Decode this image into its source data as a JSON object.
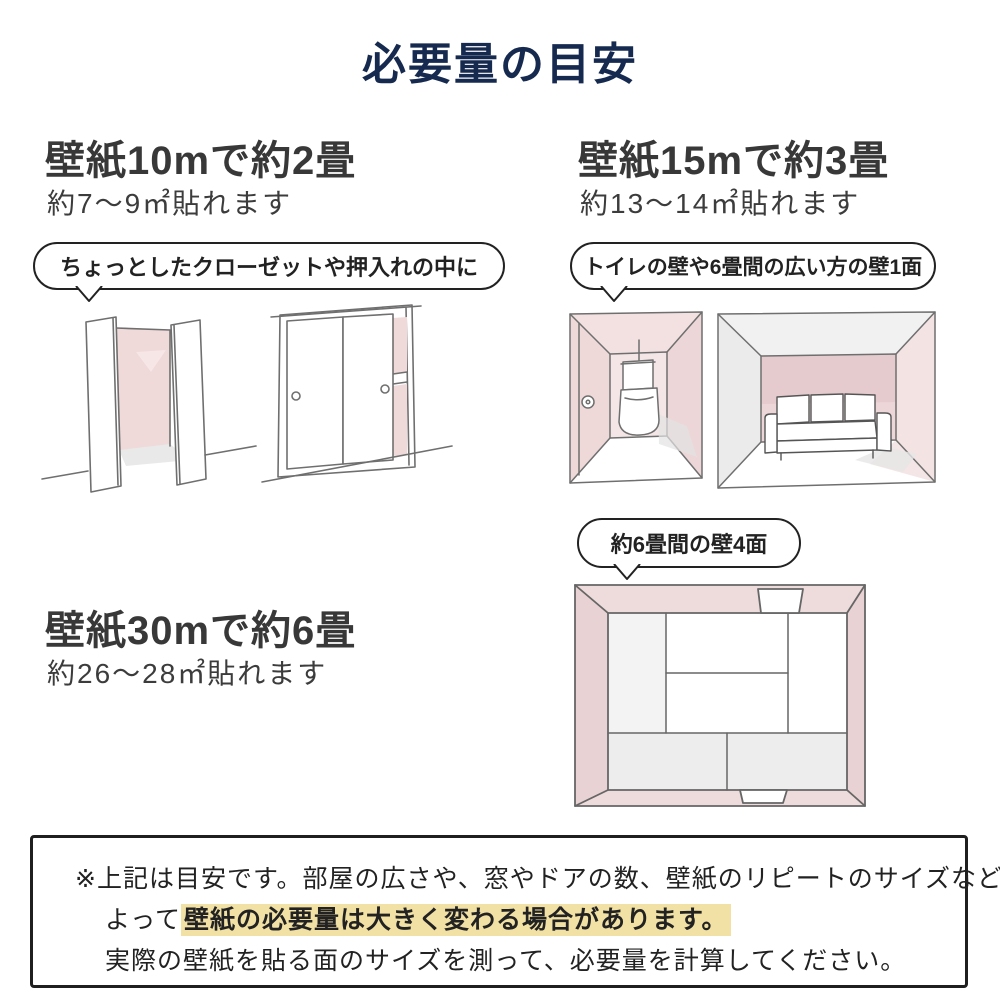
{
  "title": "必要量の目安",
  "sections": {
    "s10": {
      "heading": "壁紙10mで約2畳",
      "subheading": "約7〜9㎡貼れます",
      "bubble": "ちょっとしたクローゼットや押入れの中に"
    },
    "s15": {
      "heading": "壁紙15mで約3畳",
      "subheading": "約13〜14㎡貼れます",
      "bubble": "トイレの壁や6畳間の広い方の壁1面"
    },
    "s30": {
      "heading": "壁紙30mで約6畳",
      "subheading": "約26〜28㎡貼れます",
      "bubble": "約6畳間の壁4面"
    }
  },
  "note": {
    "line1": "※上記は目安です。部屋の広さや、窓やドアの数、壁紙のリピートのサイズなどに",
    "line2_prefix": "よって",
    "line2_highlight": "壁紙の必要量は大きく変わる場合があります。",
    "line3": "実際の壁紙を貼る面のサイズを測って、必要量を計算してください。"
  },
  "colors": {
    "accent_navy": "#16294e",
    "wall_pink": "#eedbdb",
    "highlight": "#f2e1a4",
    "text": "#383838"
  }
}
